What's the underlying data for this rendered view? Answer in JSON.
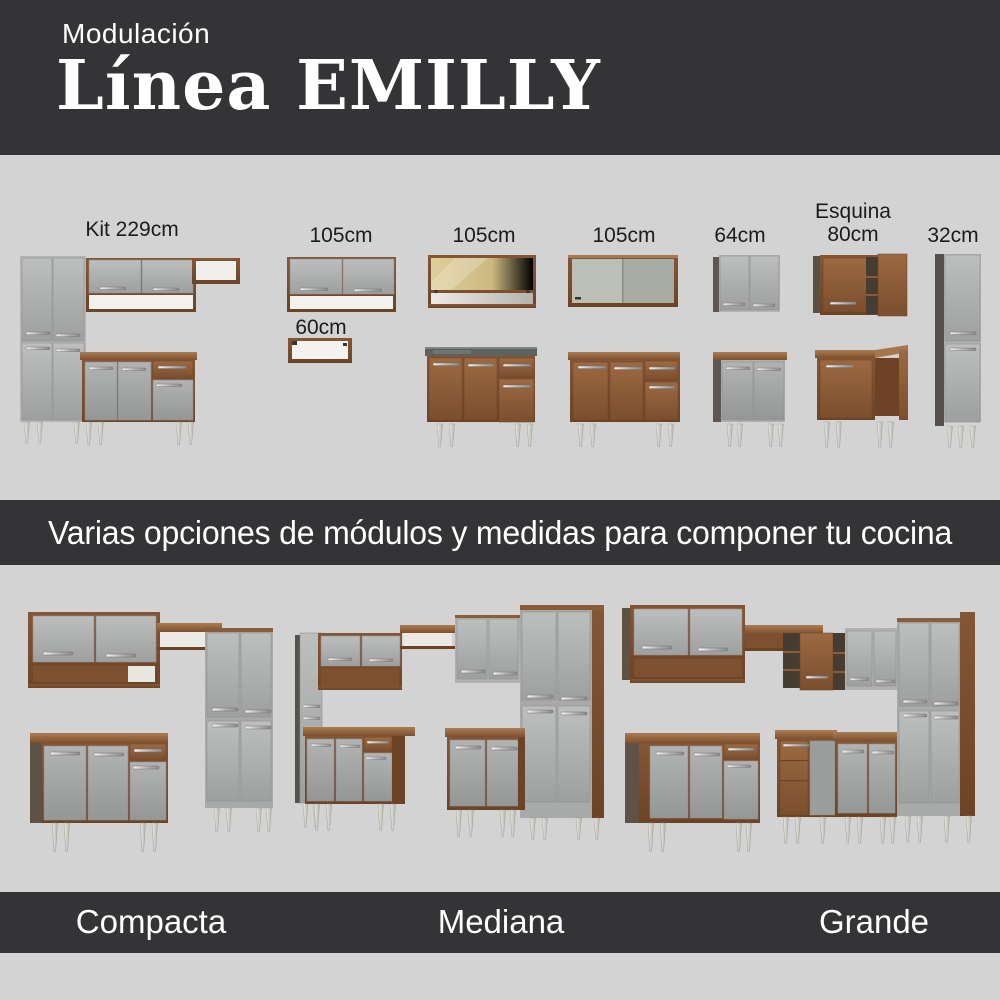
{
  "colors": {
    "background": "#d3d3d3",
    "banner": "#343335",
    "text_dark": "#1c1c1c",
    "text_light": "#ffffff",
    "wood": "#8a5a38",
    "door_gray": "#a8aaa9"
  },
  "header": {
    "eyebrow": "Modulación",
    "title": "Línea EMILLY"
  },
  "modules": {
    "kit": "Kit 229cm",
    "wall_105_a": "105cm",
    "niche_60": "60cm",
    "glass_105": "105cm",
    "open_105": "105cm",
    "wall_64": "64cm",
    "corner_line1": "Esquina",
    "corner_line2": "80cm",
    "tall_32": "32cm"
  },
  "tagline": "Varias opciones de módulos y medidas para componer tu cocina",
  "kitchen_sizes": {
    "compacta": "Compacta",
    "mediana": "Mediana",
    "grande": "Grande"
  }
}
